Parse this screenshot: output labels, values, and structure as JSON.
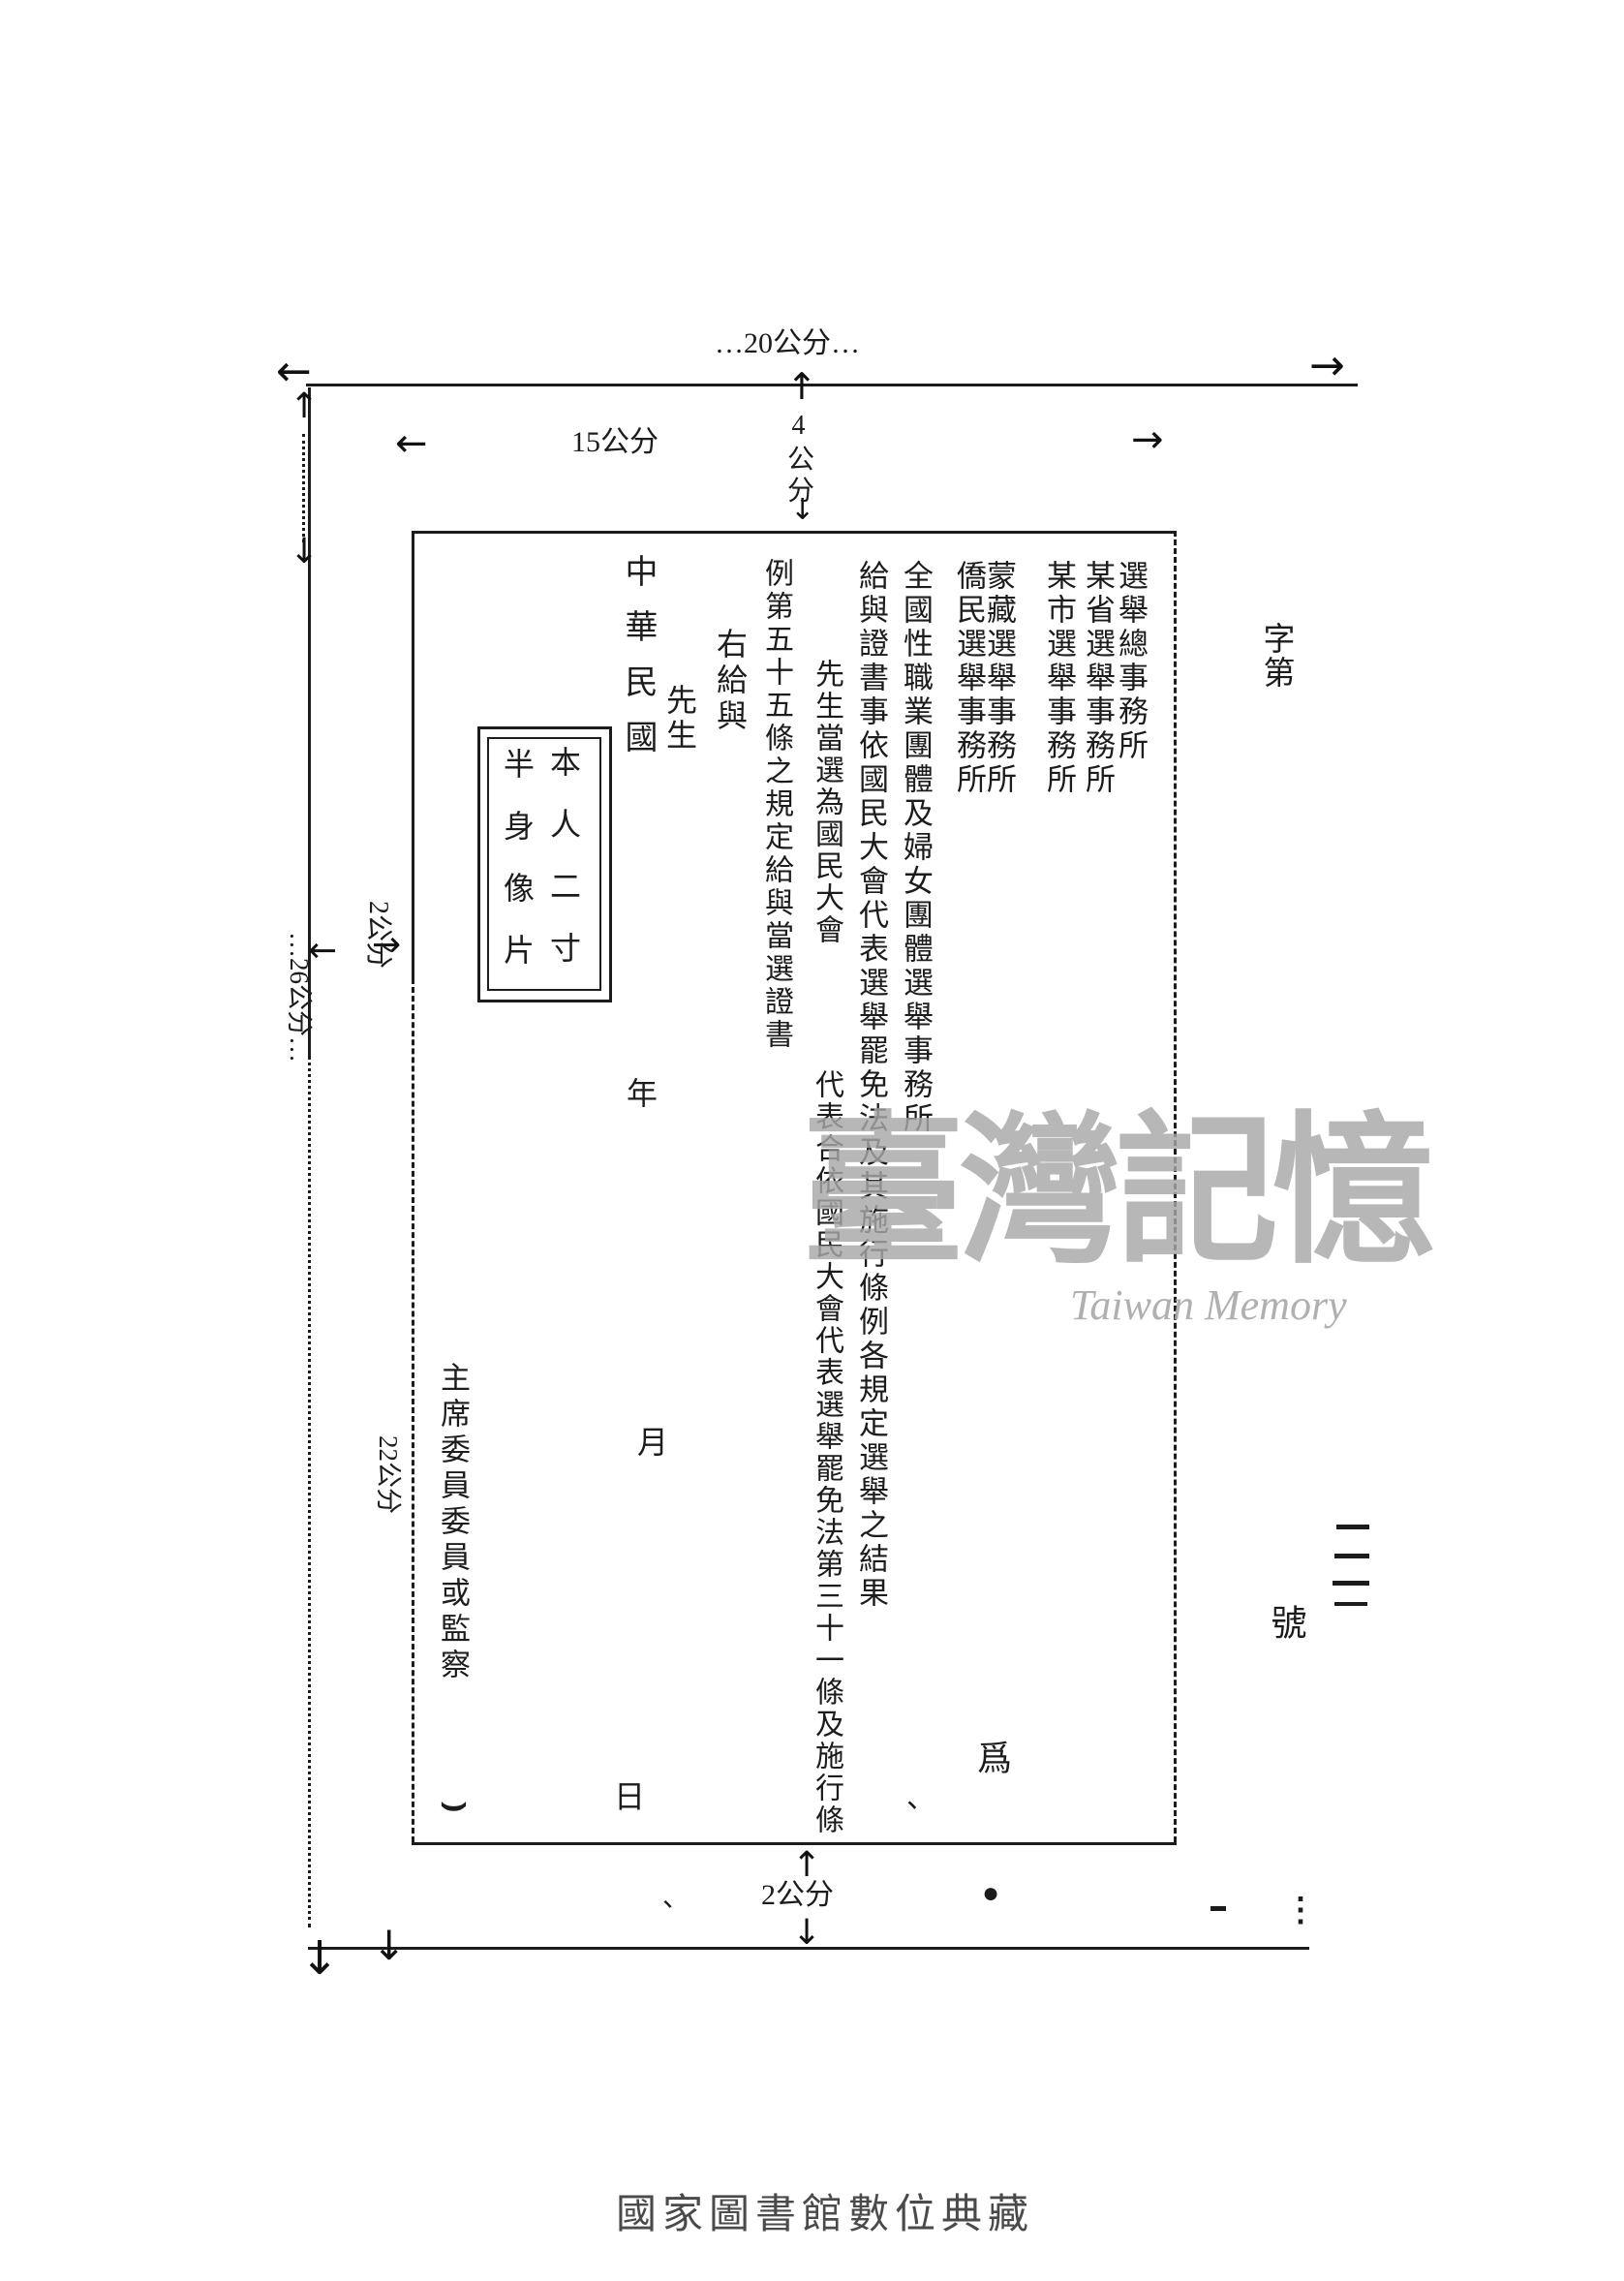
{
  "page": {
    "background": "#ffffff",
    "ink_color": "#1c1c1c",
    "watermark_color": "#a8a8a8",
    "caption_color": "#4a4a4a"
  },
  "icons": {
    "arrow_left": "←",
    "arrow_right": "→",
    "arrow_up": "↑",
    "arrow_down": "↓"
  },
  "dimension_labels": {
    "outer_width": "…20公分…",
    "inner_width": "15公分",
    "top_margin": "4公分",
    "left_margin": "2公分",
    "outer_height": "…26公分…",
    "inner_height": "22公分",
    "bottom_margin": "2公分"
  },
  "serial": {
    "prefix": "字第",
    "suffix": "號",
    "tally_marks": "一一一一"
  },
  "certificate": {
    "offices": [
      "選舉總事務所",
      "某省選舉事務所",
      "某市選舉事務所",
      "蒙藏選舉事務所",
      "僑民選舉事務所",
      "全國性職業團體及婦女團體選舉事務所"
    ],
    "preamble": "給與證書事依國民大會代表選舉罷免法及其施行條例各規定選舉之結果",
    "award_line_top": "先生當選為國民大會",
    "award_line_bottom": "代表合依國民大會代表選舉罷免法第三十一條及施行條",
    "award_line_wrap": "例第五十五條之規定給與當選證書",
    "grant": "右給與",
    "honorific": "先生",
    "era": "中華民國",
    "year": "年",
    "month": "月",
    "day": "日",
    "photo_box_line1": "本人二寸",
    "photo_box_line2": "半身像片",
    "signature": "主席委員委員或監察",
    "seal_char": "爲"
  },
  "marks": {
    "hook": "⌣",
    "comma": "、",
    "tick": "、",
    "dot": "●",
    "vdots": "⋮"
  },
  "watermark": {
    "cjk": "臺灣記憶",
    "latin": "Taiwan Memory"
  },
  "footer": {
    "caption": "國家圖書館數位典藏"
  }
}
